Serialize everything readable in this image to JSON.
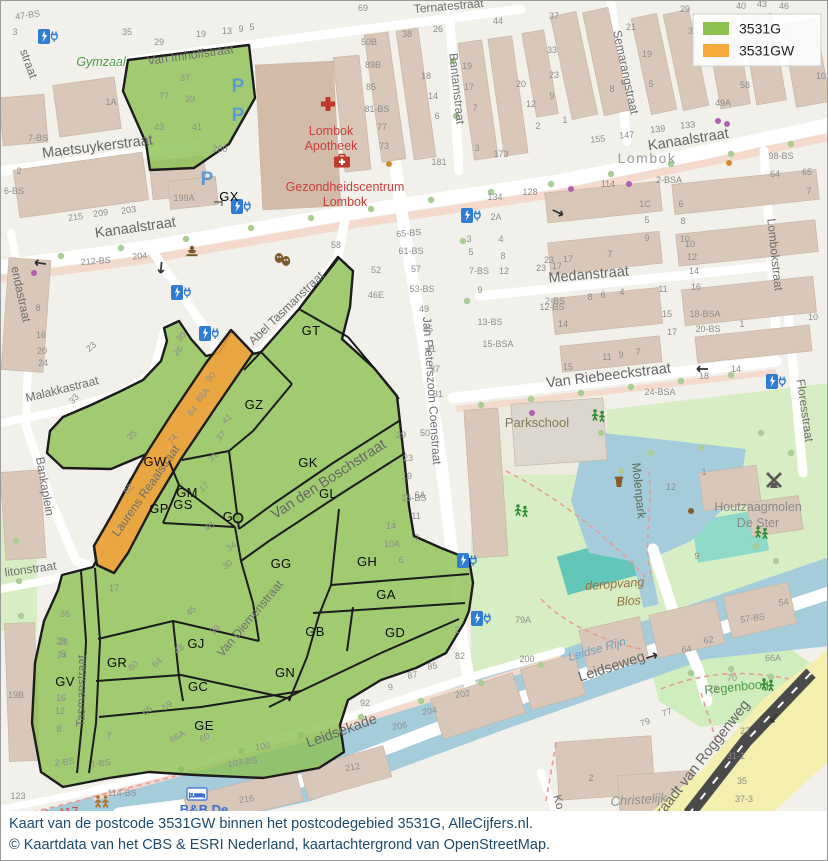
{
  "legend": {
    "items": [
      {
        "label": "3531G",
        "color": "#8CC152"
      },
      {
        "label": "3531GW",
        "color": "#F5A93B"
      }
    ]
  },
  "caption": {
    "line1": "Kaart van de postcode 3531GW binnen het postcodegebied 3531G, AlleCijfers.nl.",
    "line2": "© Kaartdata van het CBS & ESRI Nederland, kaartachtergrond van OpenStreetMap."
  },
  "colors": {
    "green_zone": "#8CC152",
    "orange_zone": "#F2A33C",
    "water": "#A5CCDB",
    "park": "#D7EEC4",
    "road": "#FFFFFF"
  },
  "regions": [
    {
      "t": "GT",
      "x": 310,
      "y": 334
    },
    {
      "t": "GZ",
      "x": 253,
      "y": 408
    },
    {
      "t": "GK",
      "x": 307,
      "y": 466
    },
    {
      "t": "GL",
      "x": 327,
      "y": 497
    },
    {
      "t": "GW",
      "x": 154,
      "y": 465
    },
    {
      "t": "GM",
      "x": 186,
      "y": 496
    },
    {
      "t": "GS",
      "x": 182,
      "y": 508
    },
    {
      "t": "GP",
      "x": 158,
      "y": 512
    },
    {
      "t": "G",
      "x": 227,
      "y": 520
    },
    {
      "t": "GG",
      "x": 280,
      "y": 567
    },
    {
      "t": "GH",
      "x": 366,
      "y": 565
    },
    {
      "t": "GA",
      "x": 385,
      "y": 598
    },
    {
      "t": "GB",
      "x": 314,
      "y": 635
    },
    {
      "t": "GD",
      "x": 394,
      "y": 636
    },
    {
      "t": "GJ",
      "x": 195,
      "y": 647
    },
    {
      "t": "GR",
      "x": 116,
      "y": 666
    },
    {
      "t": "GV",
      "x": 64,
      "y": 685
    },
    {
      "t": "GC",
      "x": 197,
      "y": 690
    },
    {
      "t": "GN",
      "x": 284,
      "y": 676
    },
    {
      "t": "GE",
      "x": 203,
      "y": 729
    },
    {
      "t": "GX",
      "x": 228,
      "y": 200
    }
  ],
  "streets": [
    {
      "t": "Van Imhoffstraat",
      "x": 190,
      "y": 58,
      "r": -8,
      "c": "st"
    },
    {
      "t": "Maetsuykerstraat",
      "x": 97,
      "y": 150,
      "r": -7,
      "c": "stb"
    },
    {
      "t": "Kanaalstraat",
      "x": 135,
      "y": 231,
      "r": -8,
      "c": "stb"
    },
    {
      "t": "Kanaalstraat",
      "x": 688,
      "y": 143,
      "r": -9,
      "c": "stb"
    },
    {
      "t": "Bantamstraat",
      "x": 452,
      "y": 88,
      "r": 84,
      "c": "st"
    },
    {
      "t": "Semarangstraat",
      "x": 621,
      "y": 72,
      "r": 78,
      "c": "st"
    },
    {
      "t": "Lombokstraat",
      "x": 770,
      "y": 254,
      "r": 84,
      "c": "st"
    },
    {
      "t": "Medanstraat",
      "x": 588,
      "y": 278,
      "r": -5,
      "c": "stb"
    },
    {
      "t": "Van Riebeeckstraat",
      "x": 608,
      "y": 379,
      "r": -7,
      "c": "stb"
    },
    {
      "t": "Floresstraat",
      "x": 800,
      "y": 410,
      "r": 82,
      "c": "st"
    },
    {
      "t": "Jan Pieterszoon Coenstraat",
      "x": 427,
      "y": 390,
      "r": 86,
      "c": "st"
    },
    {
      "t": "Abel Tasmanstraat",
      "x": 288,
      "y": 310,
      "r": -44,
      "c": "st"
    },
    {
      "t": "Tasmanstraat",
      "x": 84,
      "y": 690,
      "r": -89,
      "c": "st"
    },
    {
      "t": "Laurens Reaalstraat",
      "x": 148,
      "y": 492,
      "r": -55,
      "c": "st"
    },
    {
      "t": "Van den Boschstraat",
      "x": 330,
      "y": 482,
      "r": -33,
      "c": "stb"
    },
    {
      "t": "Van Diemenstraat",
      "x": 252,
      "y": 620,
      "r": -50,
      "c": "st"
    },
    {
      "t": "Leidseweg",
      "x": 612,
      "y": 670,
      "r": -18,
      "c": "stb"
    },
    {
      "t": "Leidsekade",
      "x": 342,
      "y": 734,
      "r": -20,
      "c": "stb"
    },
    {
      "t": "litonstraat",
      "x": 30,
      "y": 572,
      "r": -8,
      "c": "st"
    },
    {
      "t": "Bankaplein",
      "x": 40,
      "y": 486,
      "r": 80,
      "c": "st"
    },
    {
      "t": "Malakkastraat",
      "x": 62,
      "y": 392,
      "r": -14,
      "c": "st"
    },
    {
      "t": "endastraat",
      "x": 16,
      "y": 294,
      "r": 78,
      "c": "st"
    },
    {
      "t": "straat",
      "x": 24,
      "y": 64,
      "r": 70,
      "c": "st"
    },
    {
      "t": "Ternatestraat",
      "x": 448,
      "y": 9,
      "r": -5,
      "c": "st"
    },
    {
      "t": "Graadt van Roggenweg",
      "x": 702,
      "y": 764,
      "r": -52,
      "c": "stb"
    },
    {
      "t": "Ko",
      "x": 554,
      "y": 802,
      "r": 75,
      "c": "st"
    },
    {
      "t": "Molenpark",
      "x": 634,
      "y": 490,
      "r": 84,
      "c": "parkl"
    }
  ],
  "pois": [
    {
      "t": "Gymzaal",
      "x": 100,
      "y": 65,
      "c": "greenit"
    },
    {
      "t": "Lombok",
      "x": 330,
      "y": 134,
      "c": "red"
    },
    {
      "t": "Apotheek",
      "x": 330,
      "y": 149,
      "c": "red"
    },
    {
      "t": "Gezondheidscentrum",
      "x": 344,
      "y": 190,
      "c": "red"
    },
    {
      "t": "Lombok",
      "x": 344,
      "y": 205,
      "c": "red"
    },
    {
      "t": "Lombok",
      "x": 646,
      "y": 162,
      "c": "hood"
    },
    {
      "t": "Parkschool",
      "x": 536,
      "y": 426,
      "c": "olive"
    },
    {
      "t": "deropvang",
      "x": 614,
      "y": 587,
      "r": -4,
      "c": "brownit"
    },
    {
      "t": "Blos",
      "x": 628,
      "y": 604,
      "r": -4,
      "c": "brownit"
    },
    {
      "t": "Houtzaagmolen",
      "x": 757,
      "y": 510,
      "c": "gray"
    },
    {
      "t": "De Ster",
      "x": 757,
      "y": 526,
      "c": "gray"
    },
    {
      "t": "Regenboog",
      "x": 736,
      "y": 690,
      "r": -6,
      "c": "greenlbl"
    },
    {
      "t": "Leidse Rijn",
      "x": 597,
      "y": 652,
      "r": -16,
      "c": "waterl"
    },
    {
      "t": "Christelijk",
      "x": 638,
      "y": 803,
      "r": -4,
      "c": "grayit"
    },
    {
      "t": "Kade 117",
      "x": 52,
      "y": 817,
      "r": -6,
      "c": "red"
    },
    {
      "t": "B&B De",
      "x": 203,
      "y": 813,
      "c": "blue"
    }
  ],
  "houses": [
    [
      "47-BS",
      27,
      17,
      -8
    ],
    [
      "3",
      14,
      34
    ],
    [
      "35",
      126,
      34
    ],
    [
      "29",
      158,
      44
    ],
    [
      "19",
      200,
      36
    ],
    [
      "13",
      226,
      33
    ],
    [
      "9",
      240,
      31
    ],
    [
      "5",
      251,
      29
    ],
    [
      "1A",
      110,
      104
    ],
    [
      "77",
      163,
      98
    ],
    [
      "37",
      184,
      80
    ],
    [
      "39",
      189,
      101
    ],
    [
      "43",
      158,
      129
    ],
    [
      "41",
      196,
      129
    ],
    [
      "260",
      219,
      151
    ],
    [
      "199A",
      183,
      200
    ],
    [
      "215",
      75,
      219,
      -8
    ],
    [
      "209",
      100,
      215,
      -8
    ],
    [
      "203",
      128,
      212,
      -8
    ],
    [
      "2",
      18,
      173
    ],
    [
      "6-BS",
      13,
      193
    ],
    [
      "7-BS",
      37,
      140
    ],
    [
      "212-BS",
      95,
      263,
      -5
    ],
    [
      "204",
      139,
      258,
      -5
    ],
    [
      "8",
      37,
      310
    ],
    [
      "16",
      40,
      337
    ],
    [
      "20",
      41,
      353
    ],
    [
      "24",
      42,
      365
    ],
    [
      "23",
      92,
      348,
      -40
    ],
    [
      "69",
      362,
      10
    ],
    [
      "50B",
      368,
      44
    ],
    [
      "89B",
      372,
      67
    ],
    [
      "85",
      370,
      89
    ],
    [
      "81-BS",
      376,
      111
    ],
    [
      "77",
      381,
      129
    ],
    [
      "73",
      383,
      148
    ],
    [
      "38",
      406,
      36
    ],
    [
      "26",
      437,
      31
    ],
    [
      "18",
      425,
      78
    ],
    [
      "14",
      432,
      98
    ],
    [
      "6",
      436,
      118
    ],
    [
      "19",
      466,
      68
    ],
    [
      "17",
      468,
      89
    ],
    [
      "7",
      474,
      110
    ],
    [
      "3",
      476,
      150
    ],
    [
      "181",
      438,
      164
    ],
    [
      "173",
      500,
      156
    ],
    [
      "44",
      497,
      23
    ],
    [
      "20",
      520,
      86
    ],
    [
      "12",
      530,
      106
    ],
    [
      "2",
      537,
      128
    ],
    [
      "134",
      494,
      199
    ],
    [
      "128",
      529,
      194
    ],
    [
      "2A",
      495,
      219
    ],
    [
      "3",
      468,
      241
    ],
    [
      "5",
      470,
      254
    ],
    [
      "7-BS",
      478,
      273
    ],
    [
      "9",
      479,
      292
    ],
    [
      "4",
      500,
      241
    ],
    [
      "8",
      502,
      258
    ],
    [
      "12",
      503,
      273
    ],
    [
      "65-BS",
      408,
      235,
      -5
    ],
    [
      "23",
      540,
      270
    ],
    [
      "17",
      556,
      268
    ],
    [
      "12-BS",
      551,
      309
    ],
    [
      "14",
      562,
      326
    ],
    [
      "13-BS",
      489,
      324
    ],
    [
      "15-BSA",
      497,
      346
    ],
    [
      "37",
      553,
      18
    ],
    [
      "33",
      551,
      52
    ],
    [
      "23",
      553,
      77
    ],
    [
      "9",
      551,
      98
    ],
    [
      "1",
      564,
      122
    ],
    [
      "155",
      597,
      141,
      -5
    ],
    [
      "147",
      626,
      137,
      -5
    ],
    [
      "139",
      657,
      131,
      -5
    ],
    [
      "133",
      687,
      127,
      -5
    ],
    [
      "21",
      630,
      29
    ],
    [
      "19",
      646,
      56
    ],
    [
      "8",
      611,
      91
    ],
    [
      "5",
      650,
      86
    ],
    [
      "29",
      684,
      11
    ],
    [
      "33",
      692,
      33
    ],
    [
      "49A",
      722,
      105
    ],
    [
      "58",
      744,
      87
    ],
    [
      "40",
      740,
      8
    ],
    [
      "43",
      761,
      6
    ],
    [
      "46",
      783,
      8
    ],
    [
      "114",
      607,
      186
    ],
    [
      "2-BSA",
      668,
      182
    ],
    [
      "1C",
      644,
      206
    ],
    [
      "5",
      646,
      222
    ],
    [
      "9",
      646,
      240
    ],
    [
      "6",
      680,
      206
    ],
    [
      "8",
      682,
      223
    ],
    [
      "10",
      684,
      241
    ],
    [
      "98-BS",
      780,
      158
    ],
    [
      "64",
      774,
      176
    ],
    [
      "65",
      806,
      174
    ],
    [
      "7",
      808,
      193
    ],
    [
      "10",
      820,
      78
    ],
    [
      "23",
      548,
      262
    ],
    [
      "17",
      567,
      261
    ],
    [
      "7",
      609,
      256
    ],
    [
      "2-BS",
      554,
      303
    ],
    [
      "8",
      589,
      299
    ],
    [
      "6",
      602,
      297
    ],
    [
      "4",
      621,
      294
    ],
    [
      "11",
      662,
      291
    ],
    [
      "15",
      666,
      316
    ],
    [
      "17",
      671,
      334
    ],
    [
      "18-BSA",
      704,
      316
    ],
    [
      "20-BS",
      707,
      331
    ],
    [
      "1",
      741,
      326
    ],
    [
      "15",
      567,
      369
    ],
    [
      "11",
      606,
      359
    ],
    [
      "9",
      620,
      357
    ],
    [
      "7",
      637,
      354
    ],
    [
      "10",
      689,
      246
    ],
    [
      "12",
      691,
      259
    ],
    [
      "14",
      693,
      273
    ],
    [
      "16",
      695,
      289
    ],
    [
      "24-BSA",
      659,
      394
    ],
    [
      "18",
      703,
      378
    ],
    [
      "14",
      735,
      371
    ],
    [
      "10",
      812,
      319
    ],
    [
      "58",
      335,
      247
    ],
    [
      "52",
      375,
      272
    ],
    [
      "46E",
      375,
      297
    ],
    [
      "61-BS",
      410,
      253
    ],
    [
      "57",
      415,
      271
    ],
    [
      "53-BS",
      421,
      291
    ],
    [
      "49",
      423,
      311
    ],
    [
      "45",
      427,
      331
    ],
    [
      "41",
      430,
      351
    ],
    [
      "37",
      434,
      371
    ],
    [
      "31",
      437,
      396
    ],
    [
      "29",
      400,
      437
    ],
    [
      "50",
      424,
      435
    ],
    [
      "23",
      407,
      460
    ],
    [
      "19",
      406,
      478
    ],
    [
      "15-BS",
      413,
      500
    ],
    [
      "11",
      415,
      518
    ],
    [
      "7",
      416,
      540
    ],
    [
      "6",
      400,
      562
    ],
    [
      "14",
      390,
      528
    ],
    [
      "10A",
      391,
      546
    ],
    [
      "6A",
      419,
      497
    ],
    [
      "30",
      182,
      338,
      -45
    ],
    [
      "26",
      179,
      352,
      -45
    ],
    [
      "33",
      75,
      400,
      -45
    ],
    [
      "25",
      133,
      436,
      -45
    ],
    [
      "90",
      212,
      378,
      -50
    ],
    [
      "88A",
      204,
      396,
      -50
    ],
    [
      "84",
      194,
      412,
      -50
    ],
    [
      "74",
      174,
      440,
      -50
    ],
    [
      "62",
      130,
      490,
      -50
    ],
    [
      "41",
      228,
      420,
      -45
    ],
    [
      "37",
      222,
      437,
      -45
    ],
    [
      "31",
      214,
      458,
      -45
    ],
    [
      "17",
      205,
      488,
      -45
    ],
    [
      "40",
      210,
      528,
      -35
    ],
    [
      "34",
      232,
      548,
      -35
    ],
    [
      "30",
      228,
      566,
      -35
    ],
    [
      "45",
      192,
      612,
      -40
    ],
    [
      "38",
      216,
      631,
      -40
    ],
    [
      "48",
      180,
      650,
      -40
    ],
    [
      "54",
      158,
      664,
      -40
    ],
    [
      "60",
      134,
      667,
      -40
    ],
    [
      "59",
      168,
      707,
      -35
    ],
    [
      "65",
      148,
      712,
      -35
    ],
    [
      "66A",
      178,
      738,
      -30
    ],
    [
      "60",
      205,
      739,
      -30
    ],
    [
      "7",
      108,
      738
    ],
    [
      "17",
      113,
      590
    ],
    [
      "36",
      64,
      616
    ],
    [
      "28",
      62,
      644
    ],
    [
      "24",
      61,
      657
    ],
    [
      "16",
      60,
      700
    ],
    [
      "12",
      59,
      713
    ],
    [
      "8",
      58,
      731
    ],
    [
      "2-BS",
      64,
      764,
      -6
    ],
    [
      "1-BS",
      100,
      765,
      -6
    ],
    [
      "28",
      60,
      643
    ],
    [
      "5",
      62,
      656
    ],
    [
      "12",
      670,
      489
    ],
    [
      "1",
      703,
      474
    ],
    [
      "9",
      696,
      558
    ],
    [
      "54",
      783,
      604,
      -8
    ],
    [
      "57-BS",
      752,
      620,
      -8
    ],
    [
      "62",
      708,
      642,
      -8
    ],
    [
      "64",
      686,
      651,
      -8
    ],
    [
      "66A",
      772,
      660
    ],
    [
      "70",
      731,
      680
    ],
    [
      "72",
      712,
      691
    ],
    [
      "77",
      667,
      714,
      -20
    ],
    [
      "79",
      645,
      724,
      -20
    ],
    [
      "27",
      744,
      733
    ],
    [
      "31-1",
      735,
      758
    ],
    [
      "35",
      741,
      783
    ],
    [
      "37-3",
      743,
      801
    ],
    [
      "2",
      590,
      780
    ],
    [
      "200",
      526,
      661
    ],
    [
      "202",
      462,
      696,
      -8
    ],
    [
      "204",
      429,
      713,
      -8
    ],
    [
      "206",
      399,
      728,
      -8
    ],
    [
      "212",
      352,
      769,
      -10
    ],
    [
      "216",
      246,
      801,
      -8
    ],
    [
      "79A",
      522,
      622
    ],
    [
      "82",
      459,
      658
    ],
    [
      "85",
      432,
      668,
      -10
    ],
    [
      "87",
      412,
      677,
      -10
    ],
    [
      "92",
      364,
      705
    ],
    [
      "9",
      390,
      689,
      -10
    ],
    [
      "2",
      456,
      632
    ],
    [
      "100",
      262,
      748,
      -8
    ],
    [
      "103-BS",
      242,
      764,
      -8
    ],
    [
      "114-BS",
      121,
      795
    ],
    [
      "123",
      17,
      798
    ],
    [
      "19B",
      15,
      697
    ]
  ],
  "icons": [
    {
      "n": "ev-charging-icon",
      "x": 47,
      "y": 36
    },
    {
      "n": "ev-charging-icon",
      "x": 240,
      "y": 206
    },
    {
      "n": "ev-charging-icon",
      "x": 180,
      "y": 292
    },
    {
      "n": "ev-charging-icon",
      "x": 208,
      "y": 333
    },
    {
      "n": "ev-charging-icon",
      "x": 470,
      "y": 215
    },
    {
      "n": "ev-charging-icon",
      "x": 775,
      "y": 381
    },
    {
      "n": "ev-charging-icon",
      "x": 466,
      "y": 560
    },
    {
      "n": "ev-charging-icon",
      "x": 480,
      "y": 618
    },
    {
      "n": "parking-icon",
      "x": 237,
      "y": 84
    },
    {
      "n": "parking-icon",
      "x": 237,
      "y": 113
    },
    {
      "n": "parking-icon",
      "x": 206,
      "y": 177
    },
    {
      "n": "pharmacy-cross-icon",
      "x": 327,
      "y": 103
    },
    {
      "n": "first-aid-kit-icon",
      "x": 341,
      "y": 160
    },
    {
      "n": "theater-masks-icon",
      "x": 282,
      "y": 259
    },
    {
      "n": "monument-icon",
      "x": 191,
      "y": 252
    },
    {
      "n": "windmill-icon",
      "x": 773,
      "y": 481
    },
    {
      "n": "picnic-bin-icon",
      "x": 618,
      "y": 482
    },
    {
      "n": "playground-icon",
      "x": 597,
      "y": 415
    },
    {
      "n": "playground-icon",
      "x": 520,
      "y": 510
    },
    {
      "n": "playground-icon",
      "x": 760,
      "y": 532
    },
    {
      "n": "playground-icon",
      "x": 766,
      "y": 684
    },
    {
      "n": "pedestrian-icon",
      "x": 100,
      "y": 801
    },
    {
      "n": "bed-icon",
      "x": 196,
      "y": 793
    },
    {
      "n": "oneway-arrow-icon",
      "x": 38,
      "y": 262,
      "r": 188
    },
    {
      "n": "oneway-arrow-icon",
      "x": 160,
      "y": 268,
      "r": 95
    },
    {
      "n": "oneway-arrow-icon",
      "x": 652,
      "y": 655,
      "r": -18
    },
    {
      "n": "oneway-arrow-icon",
      "x": 558,
      "y": 212,
      "r": 25
    },
    {
      "n": "oneway-arrow-icon",
      "x": 700,
      "y": 368,
      "r": 180
    },
    {
      "n": "oneway-arrow-icon",
      "x": 772,
      "y": 718,
      "r": 128
    }
  ]
}
